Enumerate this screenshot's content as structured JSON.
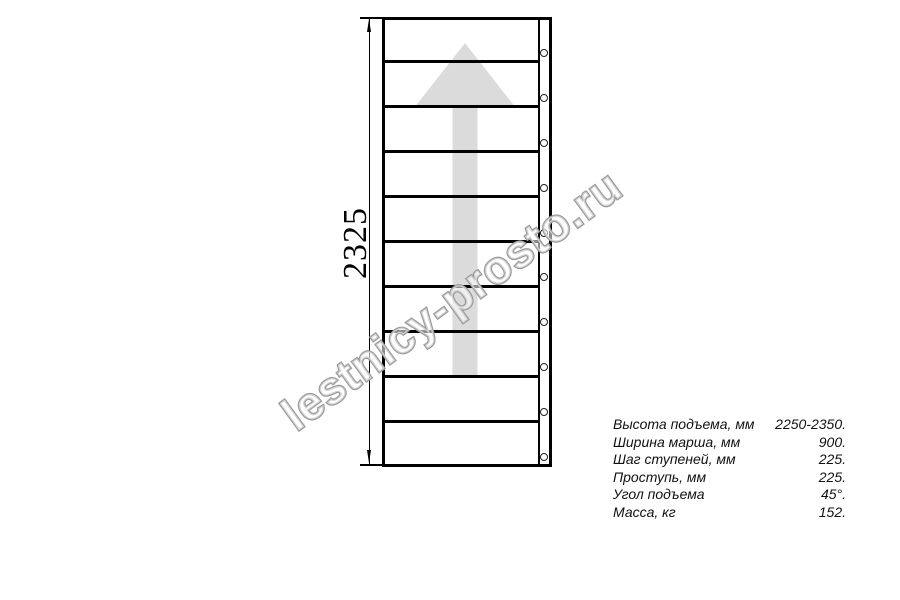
{
  "page": {
    "background_color": "#ffffff"
  },
  "watermark": {
    "text": "lestnicy-prosto.ru",
    "stroke_color": "#9b9b9b"
  },
  "drawing": {
    "type": "staircase-plan-top-view",
    "dimension_label": "2325",
    "step_count": 10,
    "line_color": "#000000",
    "arrow_color": "#dbdbdb"
  },
  "specs": {
    "rows": [
      {
        "label": "Высота подъема, мм",
        "value": "2250-2350."
      },
      {
        "label": "Ширина марша, мм",
        "value": "900."
      },
      {
        "label": "Шаг ступеней, мм",
        "value": "225."
      },
      {
        "label": "Проступь, мм",
        "value": "225."
      },
      {
        "label": "Угол подъема",
        "value": "45°."
      },
      {
        "label": "Масса, кг",
        "value": "152."
      }
    ]
  }
}
